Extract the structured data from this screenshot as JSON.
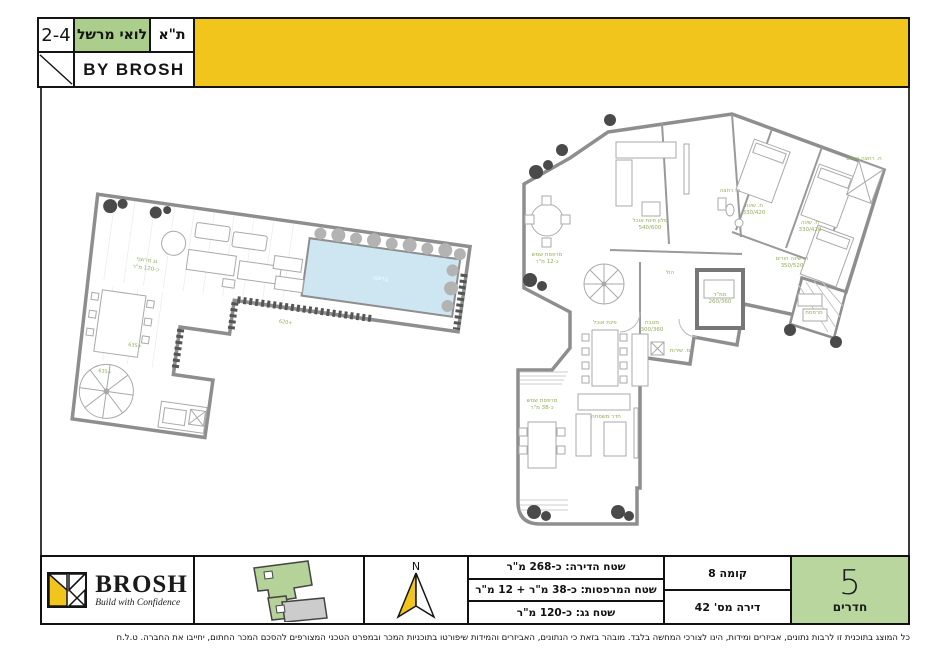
{
  "colors": {
    "banner_yellow": "#F2C51D",
    "header_green": "#ABCE8D",
    "rooms_green": "#B9D69E",
    "pool_blue": "#CDE6F2",
    "label_green": "#8FAE5A"
  },
  "header": {
    "number": "2-4",
    "street": "לואי מרשל",
    "city": "ת\"א",
    "byline": "BY BROSH"
  },
  "roof_plan": {
    "title": "גג מרוצף",
    "area": "כ-120 מ\"ר",
    "pool": "בריכה",
    "levels": [
      "635+",
      "635+",
      "620+"
    ]
  },
  "apartment_plan": {
    "labels": [
      {
        "t": "מרפסת שמש",
        "s": "כ-12 מ\"ר"
      },
      {
        "t": "סלון פינת אוכל",
        "s": "540/600"
      },
      {
        "t": "פינת אוכל",
        "s": ""
      },
      {
        "t": "מטבח",
        "s": "300/360"
      },
      {
        "t": "הול",
        "s": ""
      },
      {
        "t": "ממ\"ד",
        "s": "260/360"
      },
      {
        "t": "ח. שינה",
        "s": "330/420"
      },
      {
        "t": "ח. שינה",
        "s": "330/420"
      },
      {
        "t": "ח. שינה הורים",
        "s": "350/520"
      },
      {
        "t": "ח. רחצה",
        "s": ""
      },
      {
        "t": "ח. רחצה הורים",
        "s": ""
      },
      {
        "t": "חדר משפחה",
        "s": ""
      },
      {
        "t": "מרפסת שמש",
        "s": "כ-38 מ\"ר"
      },
      {
        "t": "מ. שירות",
        "s": ""
      },
      {
        "t": "מרפסת",
        "s": ""
      }
    ]
  },
  "footer": {
    "logo": {
      "brand": "BROSH",
      "tagline": "Build with Confidence"
    },
    "compass": {
      "label": "N"
    },
    "areas": {
      "apartment": "שטח הדירה: כ-268 מ\"ר",
      "terraces": "שטח המרפסות: כ-38 מ\"ר + 12 מ\"ר",
      "roof": "שטח גג: כ-120 מ\"ר"
    },
    "unit": {
      "floor": "קומה 8",
      "number": "דירה מס' 42",
      "rooms_value": "5",
      "rooms_label": "חדרים"
    }
  },
  "disclaimer": "כל המוצג בתוכנית זו לרבות נתונים, אביזרים ומידות, הינו לצורכי המחשה בלבד. מובהר בזאת כי הנתונים, האביזרים והמידות שיפורטו בתוכניות המכר ובמפרט הטכני המצורפים להסכם המכר החתום, יחייבו את החברה. ט.ל.ח"
}
